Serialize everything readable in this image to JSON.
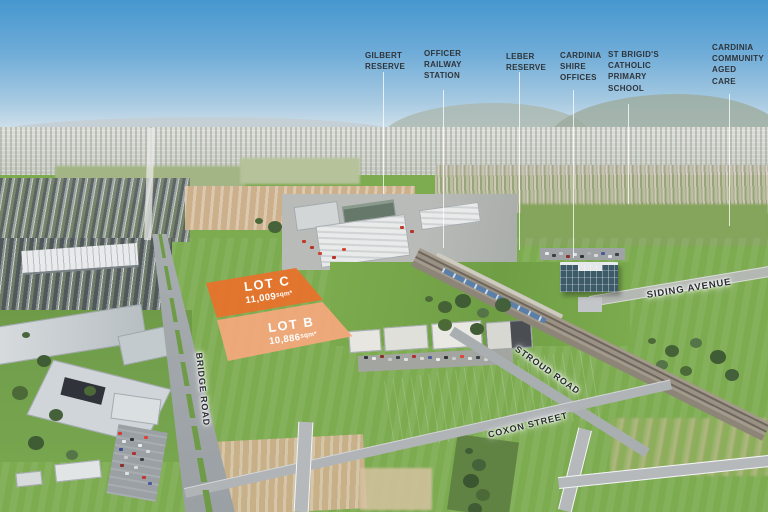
{
  "landmarks": [
    {
      "text": "GILBERT\nRESERVE"
    },
    {
      "text": "OFFICER\nRAILWAY\nSTATION"
    },
    {
      "text": "LEBER\nRESERVE"
    },
    {
      "text": "CARDINIA\nSHIRE\nOFFICES"
    },
    {
      "text": "ST BRIGID'S\nCATHOLIC\nPRIMARY\nSCHOOL"
    },
    {
      "text": "CARDINIA\nCOMMUNITY\nAGED\nCARE"
    }
  ],
  "lots": {
    "c": {
      "name": "LOT C",
      "area": "11,009",
      "unit": "sqm*"
    },
    "b": {
      "name": "LOT B",
      "area": "10,886",
      "unit": "sqm*"
    }
  },
  "roads": {
    "siding_avenue": "SIDING AVENUE",
    "stroud_road": "STROUD ROAD",
    "bridge_road": "BRIDGE ROAD",
    "coxon_street": "COXON STREET"
  },
  "colors": {
    "lot_c_fill": "#e8722c",
    "lot_b_fill": "#f4a87c",
    "annotation_text": "#2e343a",
    "sky_top": "#4697cf"
  }
}
